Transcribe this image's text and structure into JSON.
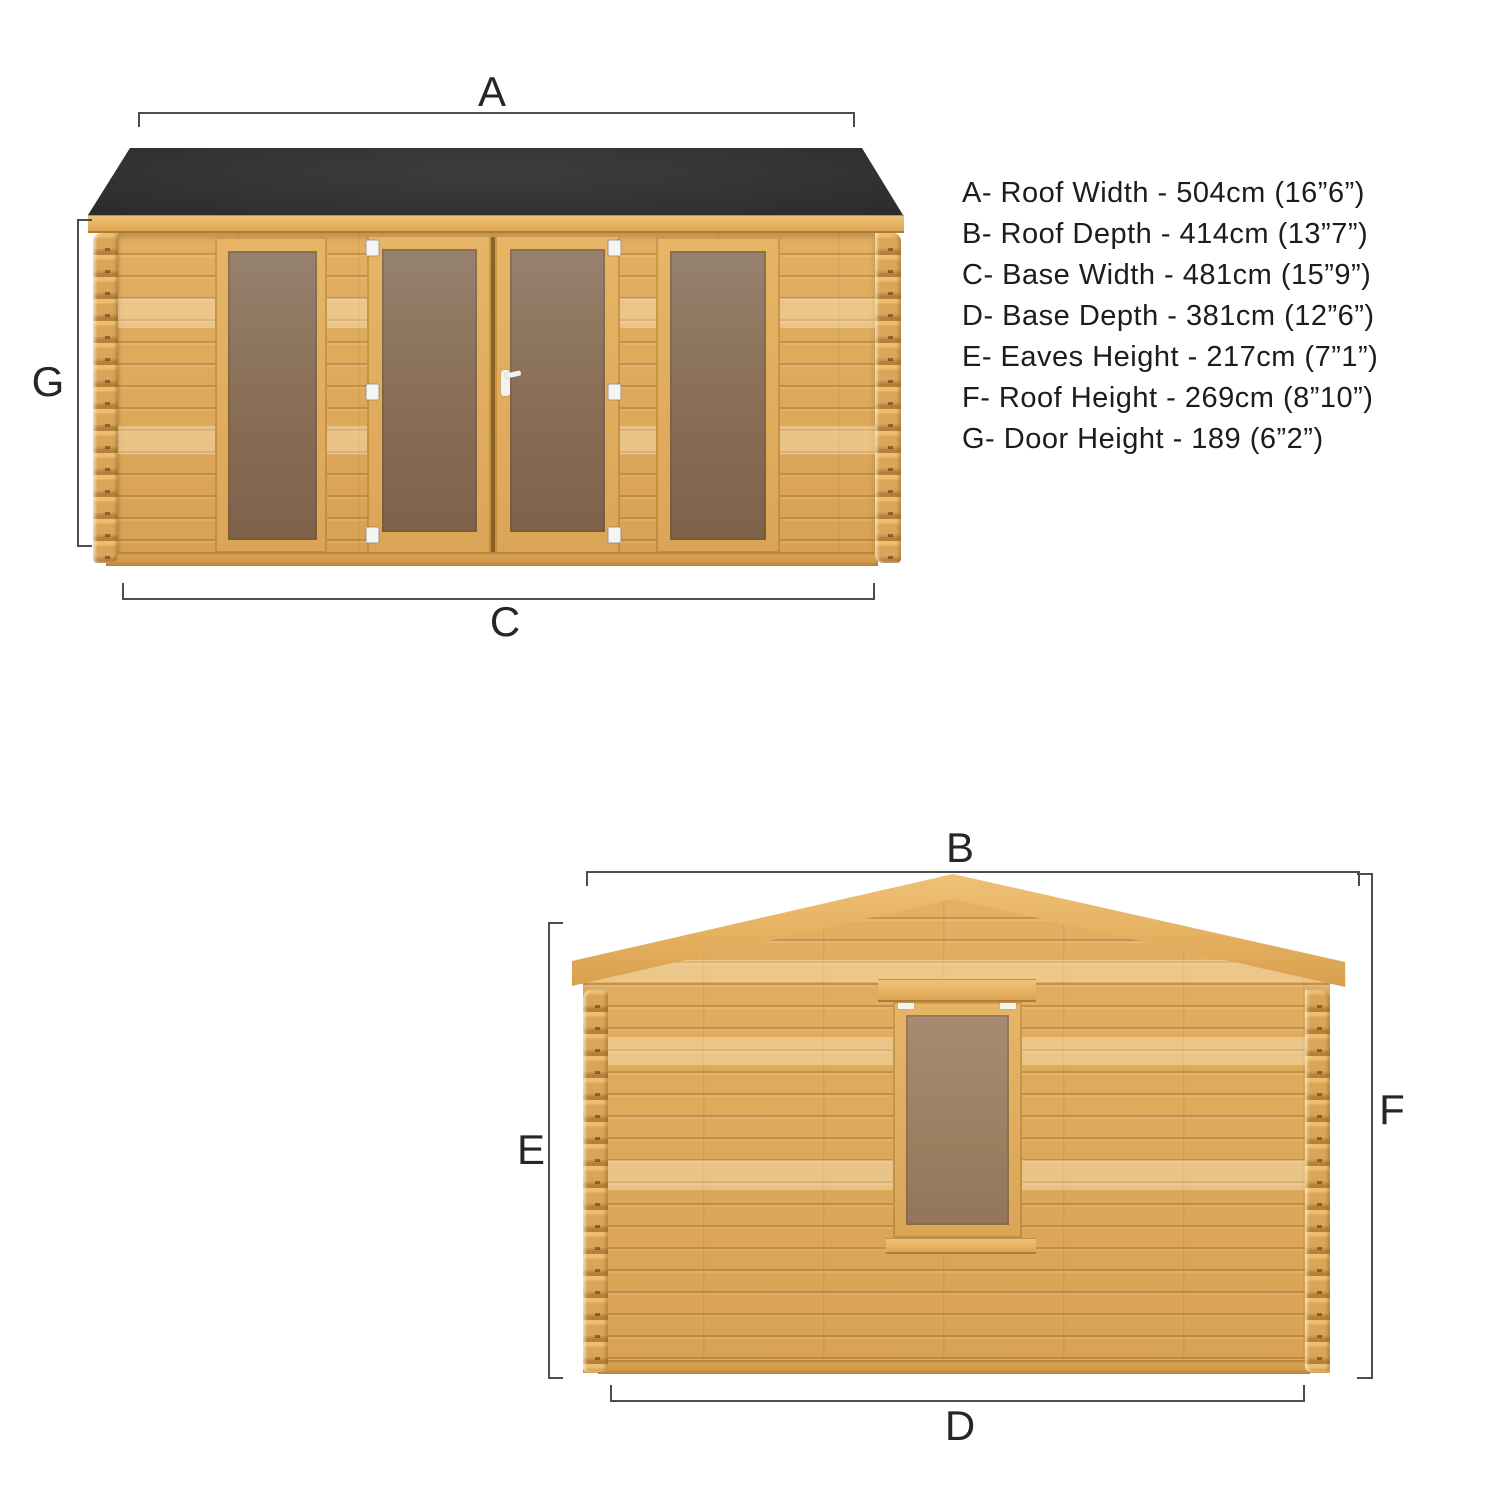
{
  "diagram_title": "Log cabin dimension diagram",
  "palette": {
    "background": "#ffffff",
    "wood": "#dcaa5e",
    "wood_light": "#eec077",
    "wood_dark": "#b5813a",
    "roof_felt": "#333333",
    "glass_front": "#8b7158",
    "glass_side": "#9c7e61",
    "dim_line": "#4d4d4d",
    "text": "#1c1c1c"
  },
  "front_view": {
    "name": "Front elevation",
    "dim_labels": {
      "a": "A",
      "c": "C",
      "g": "G"
    }
  },
  "side_view": {
    "name": "Side elevation",
    "dim_labels": {
      "b": "B",
      "d": "D",
      "e": "E",
      "f": "F"
    }
  },
  "spec_list": {
    "items": [
      {
        "key": "A",
        "name": "Roof Width",
        "metric": "504cm",
        "imperial": "16”6”",
        "text": "A- Roof Width - 504cm (16”6”)"
      },
      {
        "key": "B",
        "name": "Roof Depth",
        "metric": "414cm",
        "imperial": "13”7”",
        "text": "B- Roof Depth - 414cm (13”7”)"
      },
      {
        "key": "C",
        "name": "Base Width",
        "metric": "481cm",
        "imperial": "15”9”",
        "text": "C- Base Width - 481cm (15”9”)"
      },
      {
        "key": "D",
        "name": "Base Depth",
        "metric": "381cm",
        "imperial": "12”6”",
        "text": "D- Base Depth - 381cm (12”6”)"
      },
      {
        "key": "E",
        "name": "Eaves Height",
        "metric": "217cm",
        "imperial": "7”1”",
        "text": "E- Eaves Height - 217cm (7”1”)"
      },
      {
        "key": "F",
        "name": "Roof Height",
        "metric": "269cm",
        "imperial": "8”10”",
        "text": "F- Roof Height - 269cm (8”10”)"
      },
      {
        "key": "G",
        "name": "Door Height",
        "metric": "189",
        "imperial": "6”2”",
        "text": "G- Door Height - 189 (6”2”)"
      }
    ]
  }
}
